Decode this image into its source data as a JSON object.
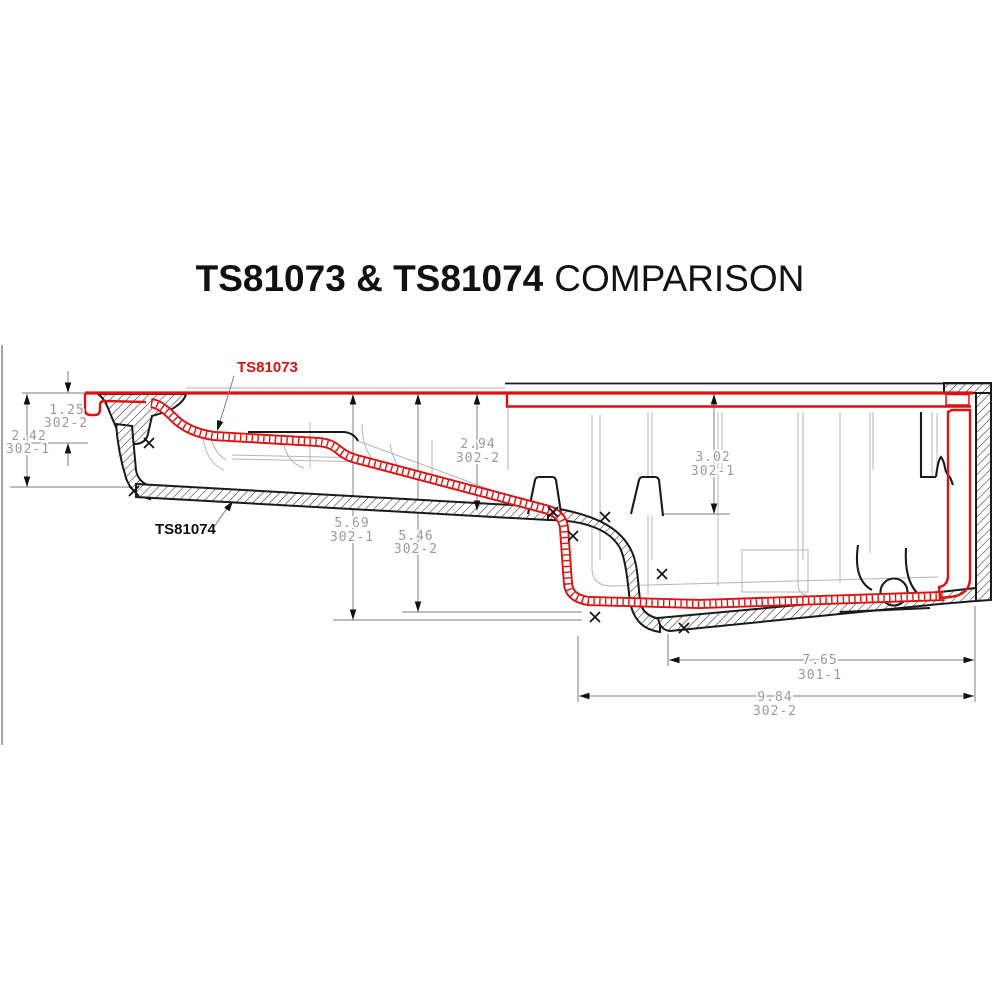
{
  "title": {
    "bold": "TS81073 & TS81074",
    "regular": "COMPARISON"
  },
  "labels": {
    "pan_red": "TS81073",
    "pan_black": "TS81074"
  },
  "colors": {
    "red_profile": "#dd1111",
    "black_profile": "#1a1a1a",
    "dimension_text": "#9a9a9a",
    "dimension_line": "#7d7d7d"
  },
  "dimensions": {
    "d_125": {
      "value": "1.25",
      "ref": "302-2"
    },
    "d_242": {
      "value": "2.42",
      "ref": "302-1"
    },
    "d_294": {
      "value": "2.94",
      "ref": "302-2"
    },
    "d_302": {
      "value": "3.02",
      "ref": "302-1"
    },
    "d_569": {
      "value": "5.69",
      "ref": "302-1"
    },
    "d_546": {
      "value": "5.46",
      "ref": "302-2"
    },
    "d_765": {
      "value": "7.65",
      "ref": "301-1"
    },
    "d_984": {
      "value": "9.84",
      "ref": "302-2"
    }
  }
}
